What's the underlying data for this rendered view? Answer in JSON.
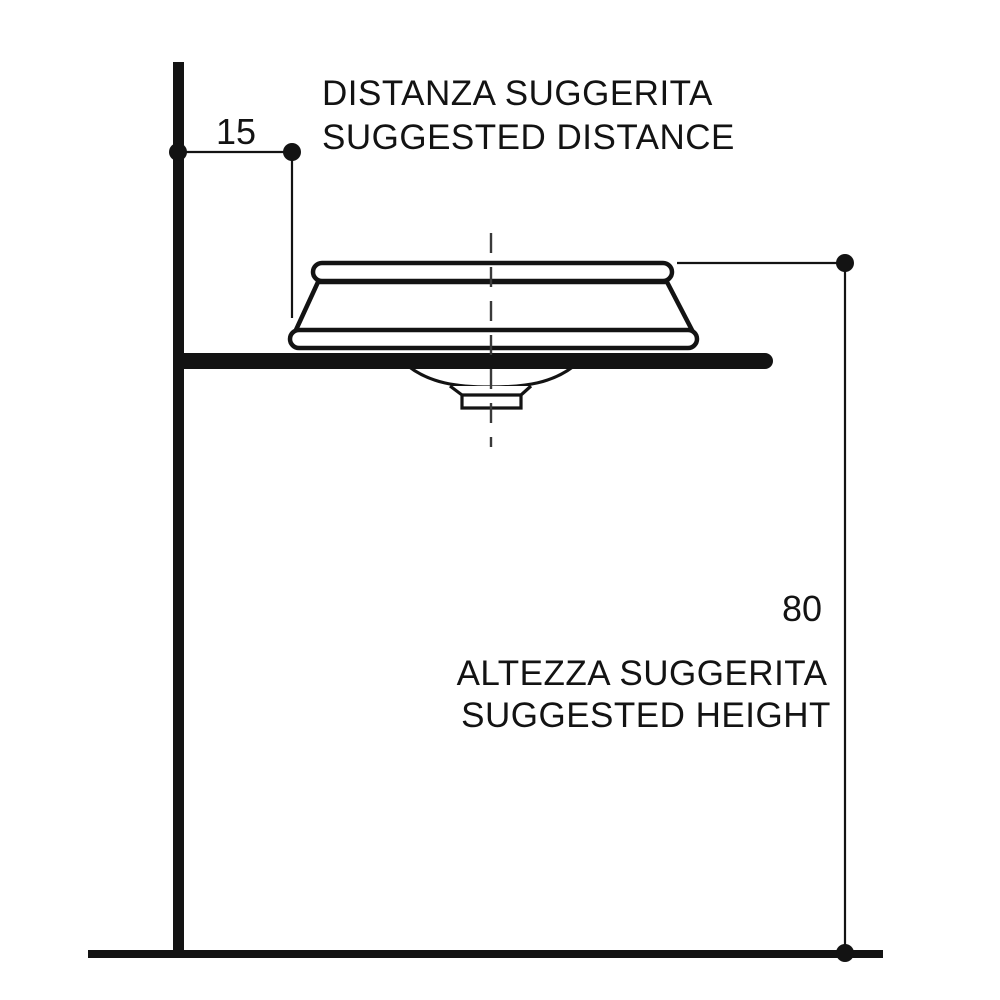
{
  "colors": {
    "background": "#ffffff",
    "ink": "#131313"
  },
  "dimensions": {
    "distance": {
      "value": "15",
      "label_line1": "DISTANZA SUGGERITA",
      "label_line2": "SUGGESTED DISTANCE"
    },
    "height": {
      "value": "80",
      "label_line1": "ALTEZZA SUGGERITA",
      "label_line2": "SUGGESTED HEIGHT"
    }
  }
}
